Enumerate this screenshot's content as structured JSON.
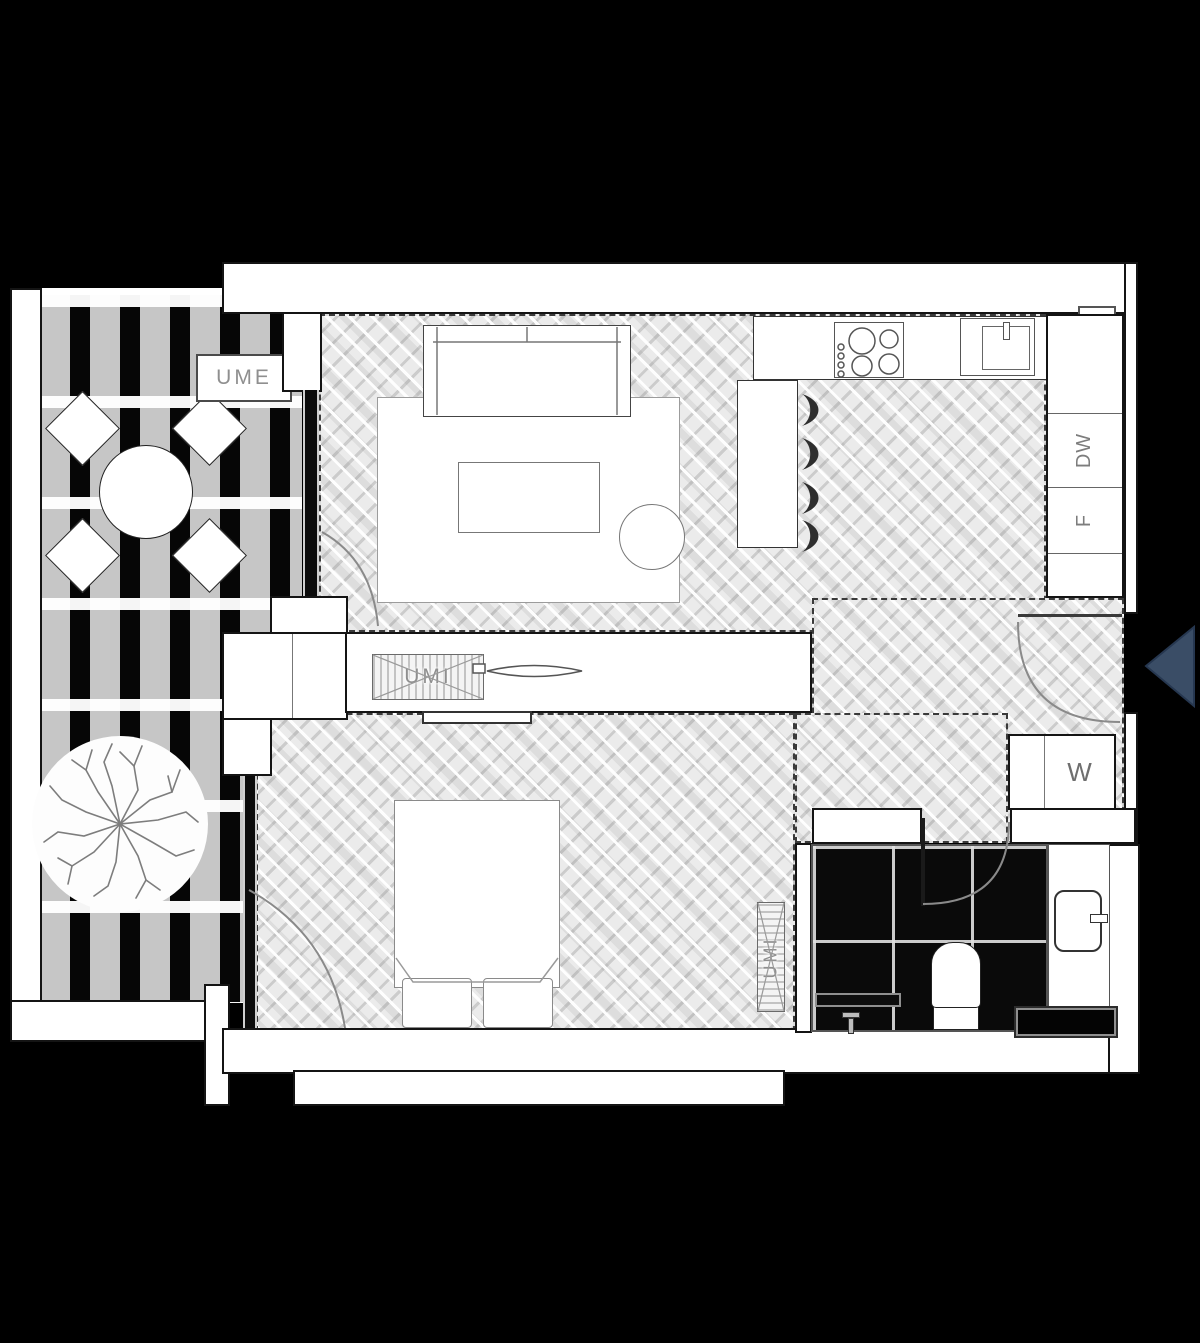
{
  "page": {
    "type": "architectural-floor-plan",
    "background": "#000000"
  },
  "labels": {
    "balcony_unit": "UME",
    "media_wall_unit": "UMI",
    "bathroom_shaft_unit": "UMI",
    "dishwasher": "DW",
    "fridge": "F",
    "washer": "W"
  },
  "colors": {
    "wall_fill": "#ffffff",
    "wall_line": "#141414",
    "wood_floor": "#ebebeb",
    "tile_floor": "#0a0a0a",
    "entry_arrow": "#3a4d66",
    "label_text": "#8f8f8f"
  },
  "symbols": {
    "entry_arrow": "left-pointing-triangle"
  }
}
